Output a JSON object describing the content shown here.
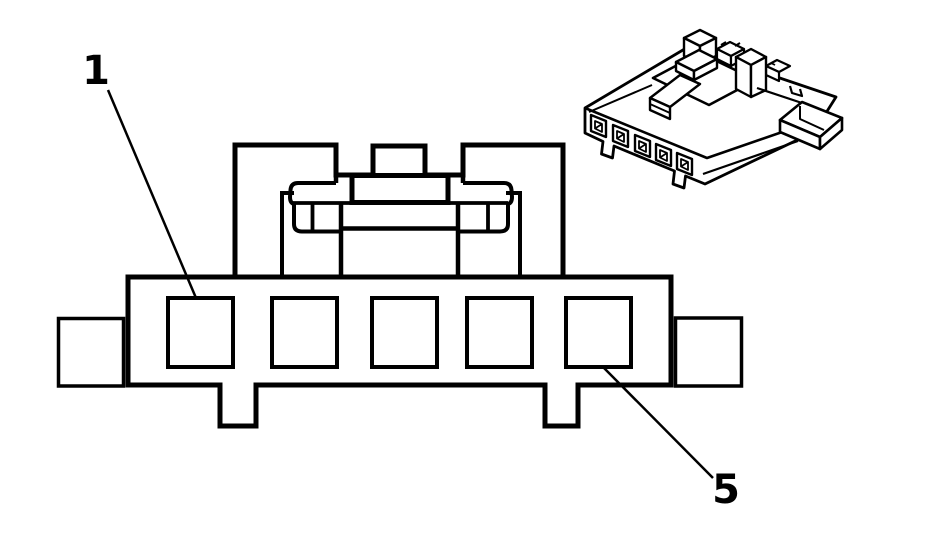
{
  "diagram": {
    "background_color": "#ffffff",
    "line_color": "#000000",
    "front_view": {
      "cavity_count": 5
    },
    "isometric_view": {
      "cavity_count": 5
    },
    "callouts": [
      {
        "label": "1",
        "points_to": "cavity-1"
      },
      {
        "label": "5",
        "points_to": "cavity-5"
      }
    ]
  }
}
